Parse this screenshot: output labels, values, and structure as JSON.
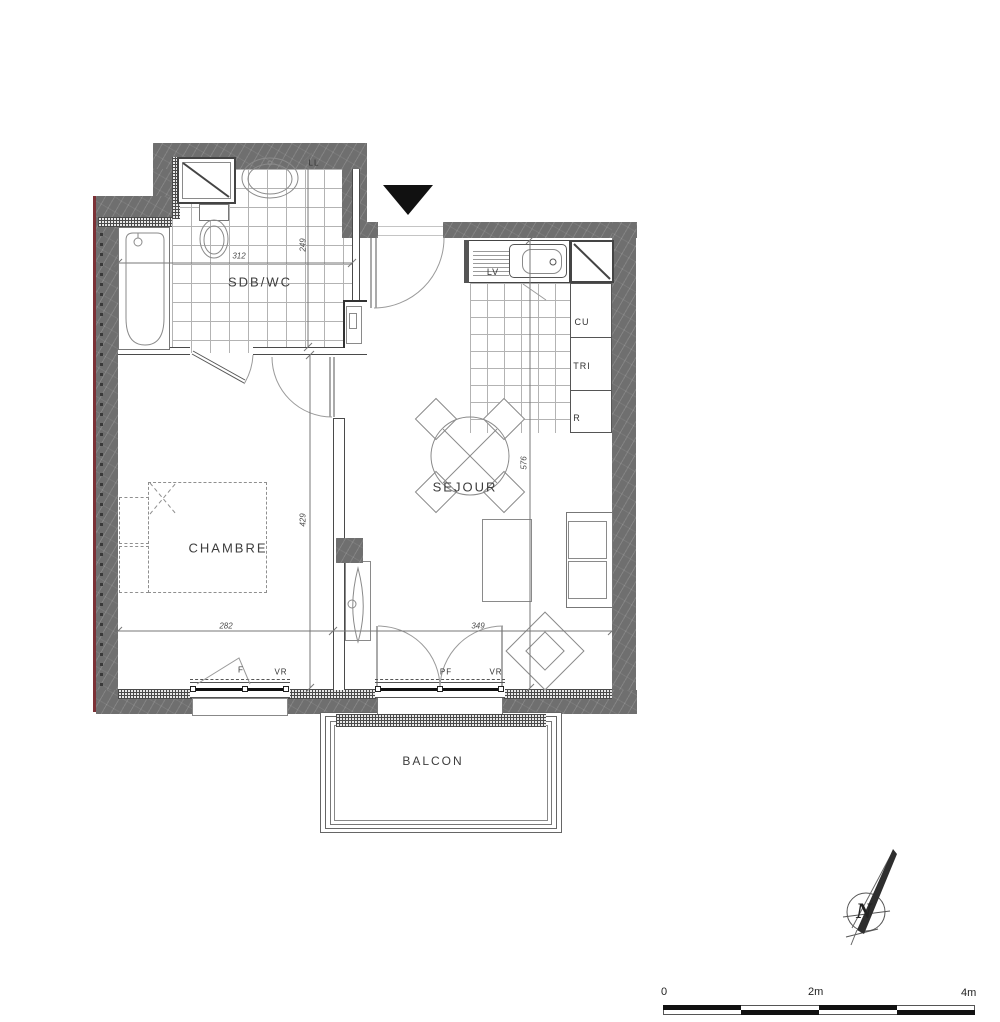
{
  "rooms": {
    "bathroom": "SDB/WC",
    "bedroom": "CHAMBRE",
    "living": "SEJOUR",
    "balcony": "BALCON"
  },
  "labels": {
    "washing_machine": "LL",
    "dishwasher": "LV",
    "cooktop": "CU",
    "sorting": "TRI",
    "fridge": "R"
  },
  "openings": {
    "window": "F",
    "shutter_bedroom": "VR",
    "french_window": "PF",
    "shutter_living": "VR"
  },
  "dims": {
    "bath_w": "312",
    "bath_d": "249",
    "bed_d": "429",
    "bed_w": "282",
    "liv_w": "349",
    "liv_d": "576"
  },
  "compass": {
    "north": "N"
  },
  "scale": {
    "zero": "0",
    "mid": "2m",
    "max": "4m"
  },
  "colors": {
    "wall": "#6f6f6f",
    "accent": "#7c3136",
    "line": "#4a4a4a"
  }
}
